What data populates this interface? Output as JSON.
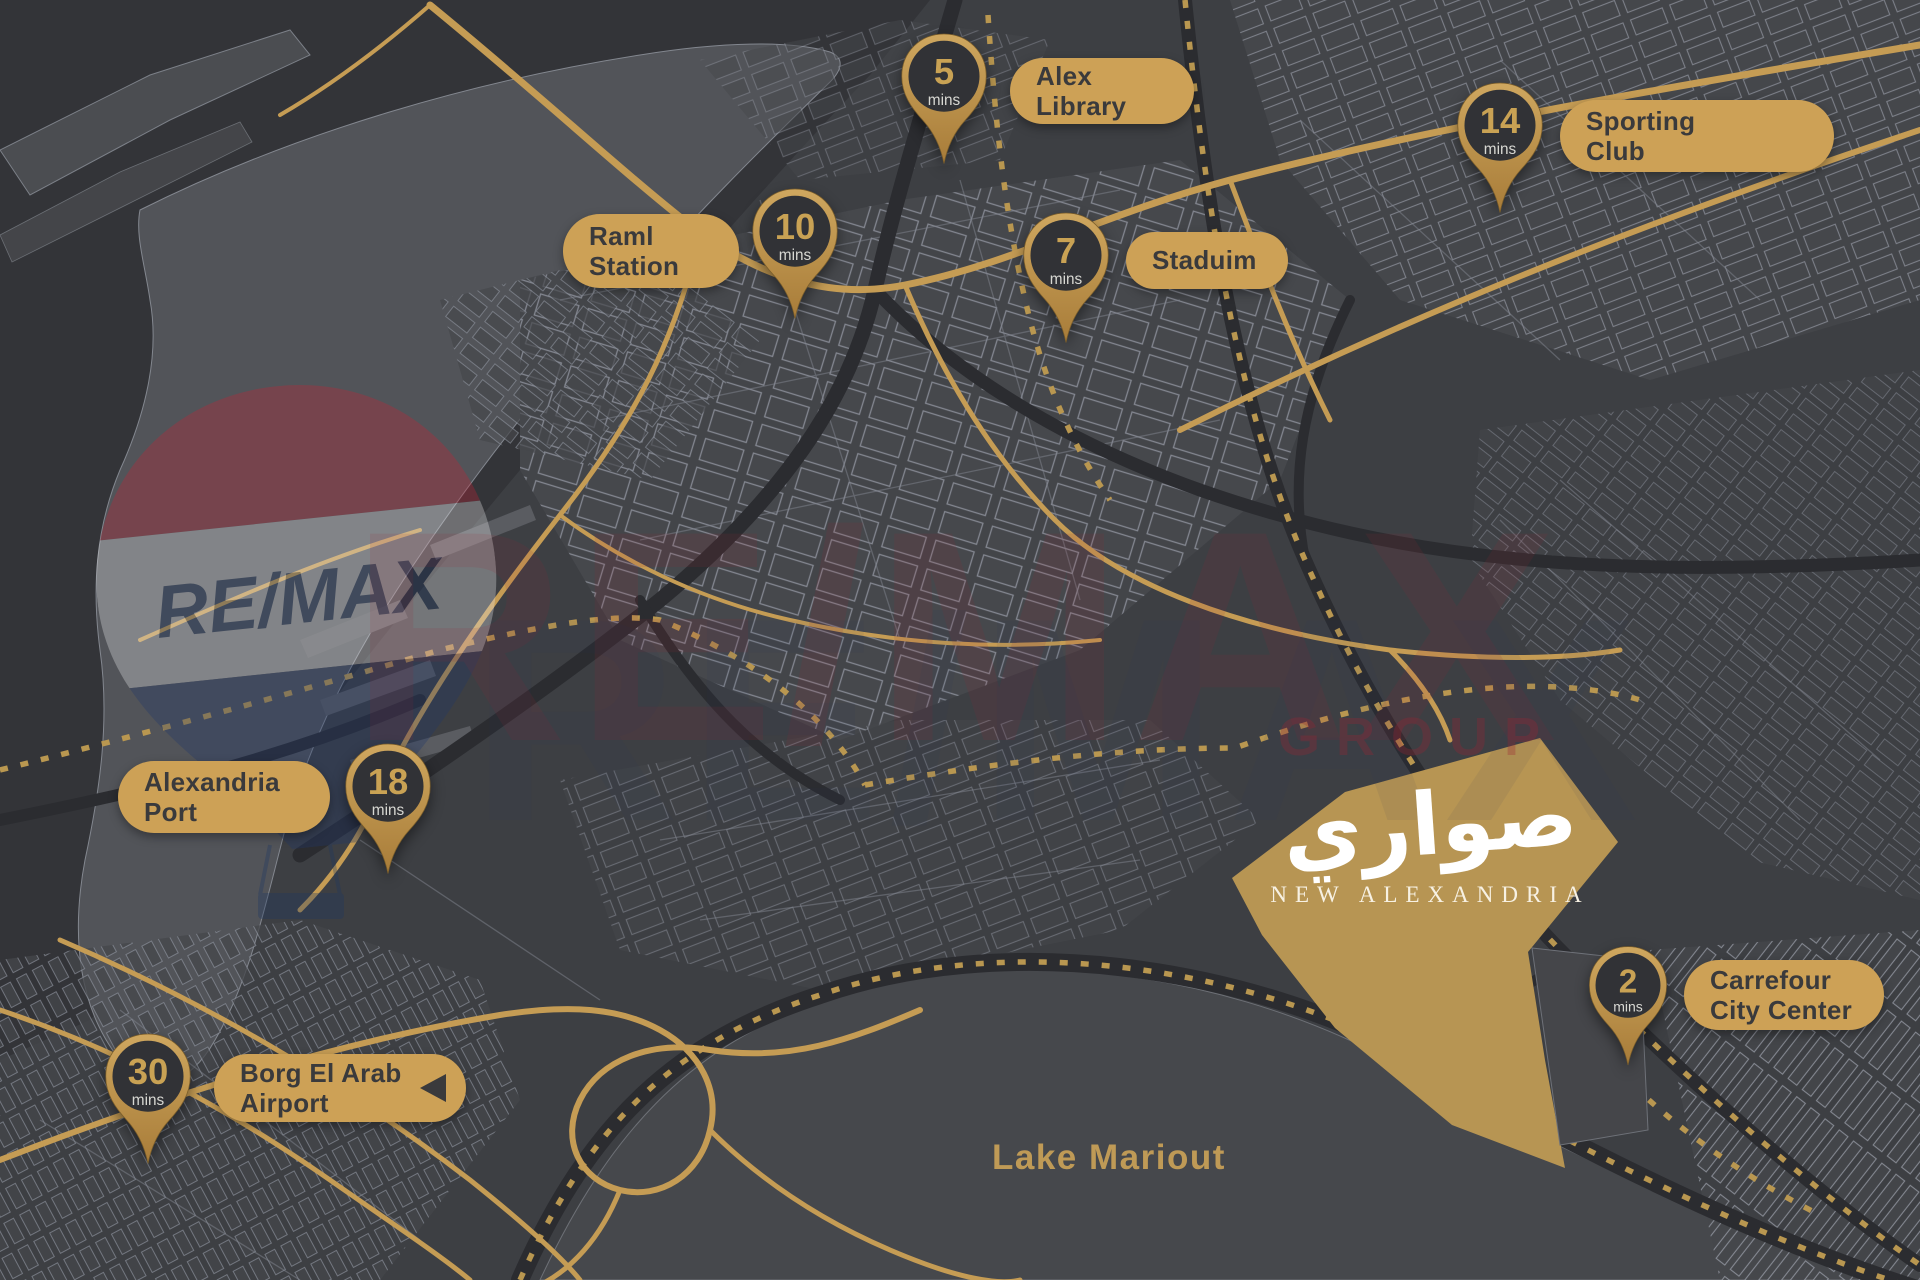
{
  "project": {
    "arabic_name": "صواري",
    "english_name": "NEW ALEXANDRIA"
  },
  "lake": {
    "label": "Lake Mariout"
  },
  "watermark": {
    "brand": "RE/MAX",
    "balloon_text": "RE/MAX",
    "secondary": "GROUP"
  },
  "colors": {
    "background": "#3d3f43",
    "water": "#333438",
    "land": "#525459",
    "lake": "#46484c",
    "gold_road": "#c59c54",
    "label_pill": "#cda156",
    "pin_inner": "#313236",
    "pin_number": "#c9a254",
    "development_parcel": "#b79553",
    "remax_red": "#9c2433",
    "remax_navy": "#24365e",
    "label_text": "#3a3a3c"
  },
  "locations": [
    {
      "slug": "alex-library",
      "lines": [
        "Alex",
        "Library"
      ],
      "time": "5",
      "unit": "mins",
      "pin": {
        "x": 896,
        "y": 31,
        "w": 96
      },
      "label": {
        "x": 1010,
        "y": 58,
        "w": 184,
        "h": 66
      }
    },
    {
      "slug": "sporting-club",
      "lines": [
        "Sporting",
        "Club"
      ],
      "time": "14",
      "unit": "mins",
      "pin": {
        "x": 1452,
        "y": 80,
        "w": 96
      },
      "label": {
        "x": 1560,
        "y": 100,
        "w": 274,
        "h": 72
      }
    },
    {
      "slug": "raml-station",
      "lines": [
        "Raml",
        "Station"
      ],
      "time": "10",
      "unit": "mins",
      "pin": {
        "x": 747,
        "y": 186,
        "w": 96
      },
      "label": {
        "x": 563,
        "y": 214,
        "w": 176,
        "h": 74
      }
    },
    {
      "slug": "stadium",
      "lines": [
        "Staduim"
      ],
      "time": "7",
      "unit": "mins",
      "pin": {
        "x": 1018,
        "y": 210,
        "w": 96
      },
      "label": {
        "x": 1126,
        "y": 232,
        "w": 162,
        "h": 57
      }
    },
    {
      "slug": "alexandria-port",
      "lines": [
        "Alexandria",
        "Port"
      ],
      "time": "18",
      "unit": "mins",
      "pin": {
        "x": 340,
        "y": 741,
        "w": 96
      },
      "label": {
        "x": 118,
        "y": 761,
        "w": 212,
        "h": 72
      }
    },
    {
      "slug": "borg-el-arab-airport",
      "lines": [
        "Borg El Arab",
        "Airport"
      ],
      "time": "30",
      "unit": "mins",
      "pin": {
        "x": 100,
        "y": 1031,
        "w": 96
      },
      "label": {
        "x": 214,
        "y": 1054,
        "w": 252,
        "h": 68
      },
      "arrow": true
    },
    {
      "slug": "carrefour-city-center",
      "lines": [
        "Carrefour",
        "City Center"
      ],
      "time": "2",
      "unit": "mins",
      "pin": {
        "x": 1584,
        "y": 944,
        "w": 88
      },
      "label": {
        "x": 1684,
        "y": 960,
        "w": 200,
        "h": 70
      }
    }
  ]
}
